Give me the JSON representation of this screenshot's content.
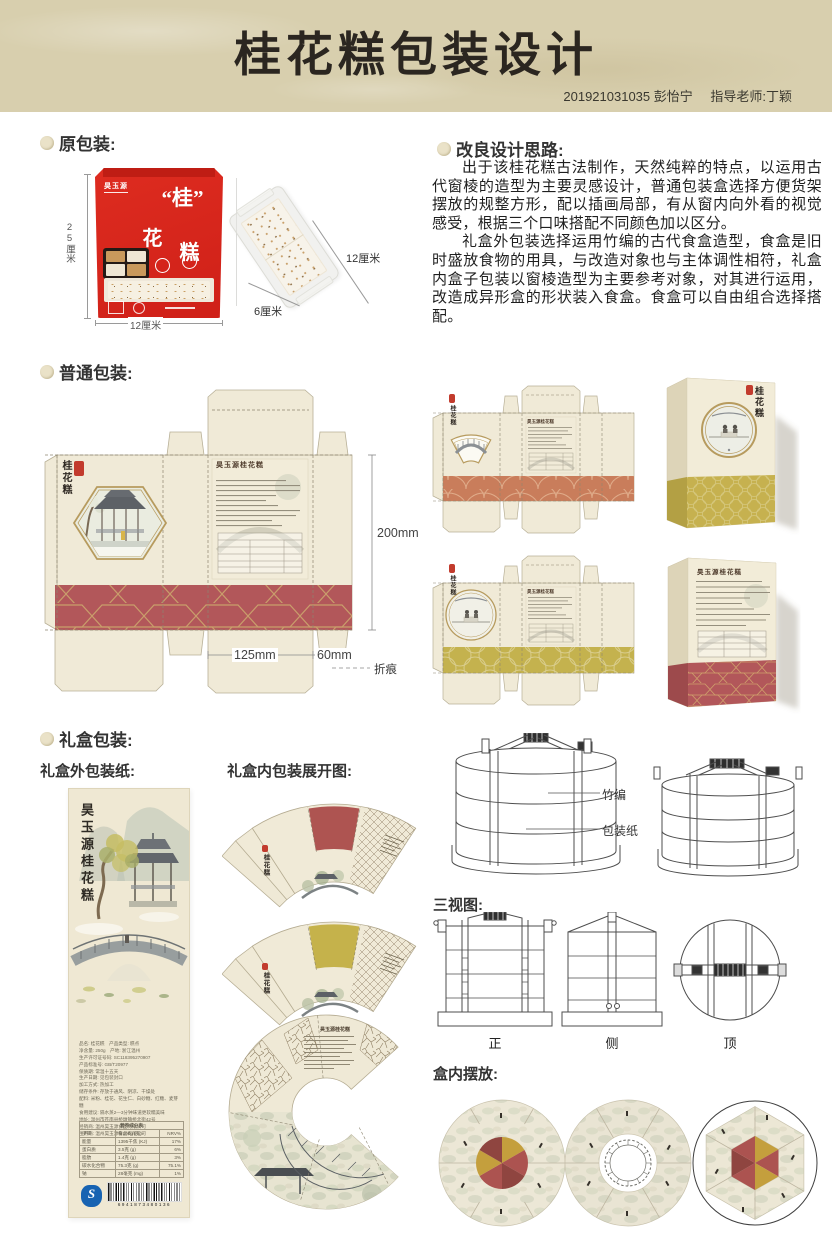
{
  "header": {
    "title": "桂花糕包装设计",
    "student": "201921031035 彭怡宁",
    "advisor": "指导老师:丁颖"
  },
  "product": {
    "short_title": "桂花糕",
    "brand": "昊玉源"
  },
  "original": {
    "heading": "原包装:",
    "bag": {
      "brand": "昊玉源",
      "char1": "“桂”",
      "char2": "花",
      "char3": "糕",
      "height_label": "25厘米",
      "width_label": "12厘米"
    },
    "piece": {
      "length_label": "12厘米",
      "width_label": "6厘米"
    }
  },
  "redesign": {
    "heading": "改良设计思路:",
    "para1": "出于该桂花糕古法制作，天然纯粹的特点，以运用古代窗棱的造型为主要灵感设计，普通包装盒选择方便货架摆放的规整方形，配以插画局部，有从窗内向外看的视觉感受，根据三个口味搭配不同颜色加以区分。",
    "para2": "礼盒外包装选择运用竹编的古代食盒造型，食盒是旧时盛放食物的用具，与改造对象也与主体调性相符，礼盒内盒子包装以窗棱造型为主要参考对象，对其进行运用，改造成异形盒的形状装入食盒。食盒可以自由组合选择搭配。"
  },
  "regular": {
    "heading": "普通包装:",
    "dims": {
      "height": "200mm",
      "width": "125mm",
      "depth": "60mm",
      "fold_legend": "折痕"
    }
  },
  "giftbox": {
    "heading": "礼盒包装:",
    "outer_heading": "礼盒外包装纸:",
    "inner_heading": "礼盒内包装展开图:",
    "cylinder_labels": {
      "weave": "竹编",
      "paper": "包装纸"
    },
    "three_views": {
      "heading": "三视图:",
      "front": "正",
      "side": "侧",
      "top": "顶"
    },
    "arrangement_heading": "盒内摆放:"
  },
  "product_label": {
    "title": "昊玉源桂花糕",
    "info_lines": [
      "品名: 桂花糕　产品类型: 糕点",
      "净含量: 250g　产地: 浙江温州",
      "生产许可证号码: SC118395270907",
      "产品标准号: GB/T20977",
      "保质期: 常温十五天",
      "生产日期: 见包装封口",
      "加工方式: 热加工",
      "储存条件: 存放于通风、阴凉、干燥处",
      "配料: 米粉、桂花、花生仁、白砂糖、红糖、麦芽糖",
      "食用建议: 隔水蒸2—3分钟味道更软糯美味",
      "地址: 温州市苍南县桥墩镇桥北街42号",
      "经销商: 温州昊玉源食品有限公司",
      "生产商: 温州昊玉源食品有限公司"
    ],
    "nutrition": {
      "title": "营养成分表",
      "header": [
        "项目",
        "每100g (克)",
        "NRV%"
      ],
      "rows": [
        [
          "能量",
          "1395千焦 (KJ)",
          "17%"
        ],
        [
          "蛋白质",
          "3.5克 (g)",
          "6%"
        ],
        [
          "脂肪",
          "1.4克 (g)",
          "3%"
        ],
        [
          "碳水化合物",
          "75.3克 (g)",
          "75.1%"
        ],
        [
          "钠",
          "28毫克 (mg)",
          "1%"
        ]
      ]
    },
    "barcode": "6941873480136"
  },
  "colors": {
    "header_bg": "#d8cfae",
    "paper_cream": "#f0ead7",
    "band_red": "#b2575a",
    "band_salmon": "#c97d5b",
    "band_olive": "#c4b24e",
    "bag_red": "#d6251d",
    "gold_rim": "#b79b5e"
  }
}
